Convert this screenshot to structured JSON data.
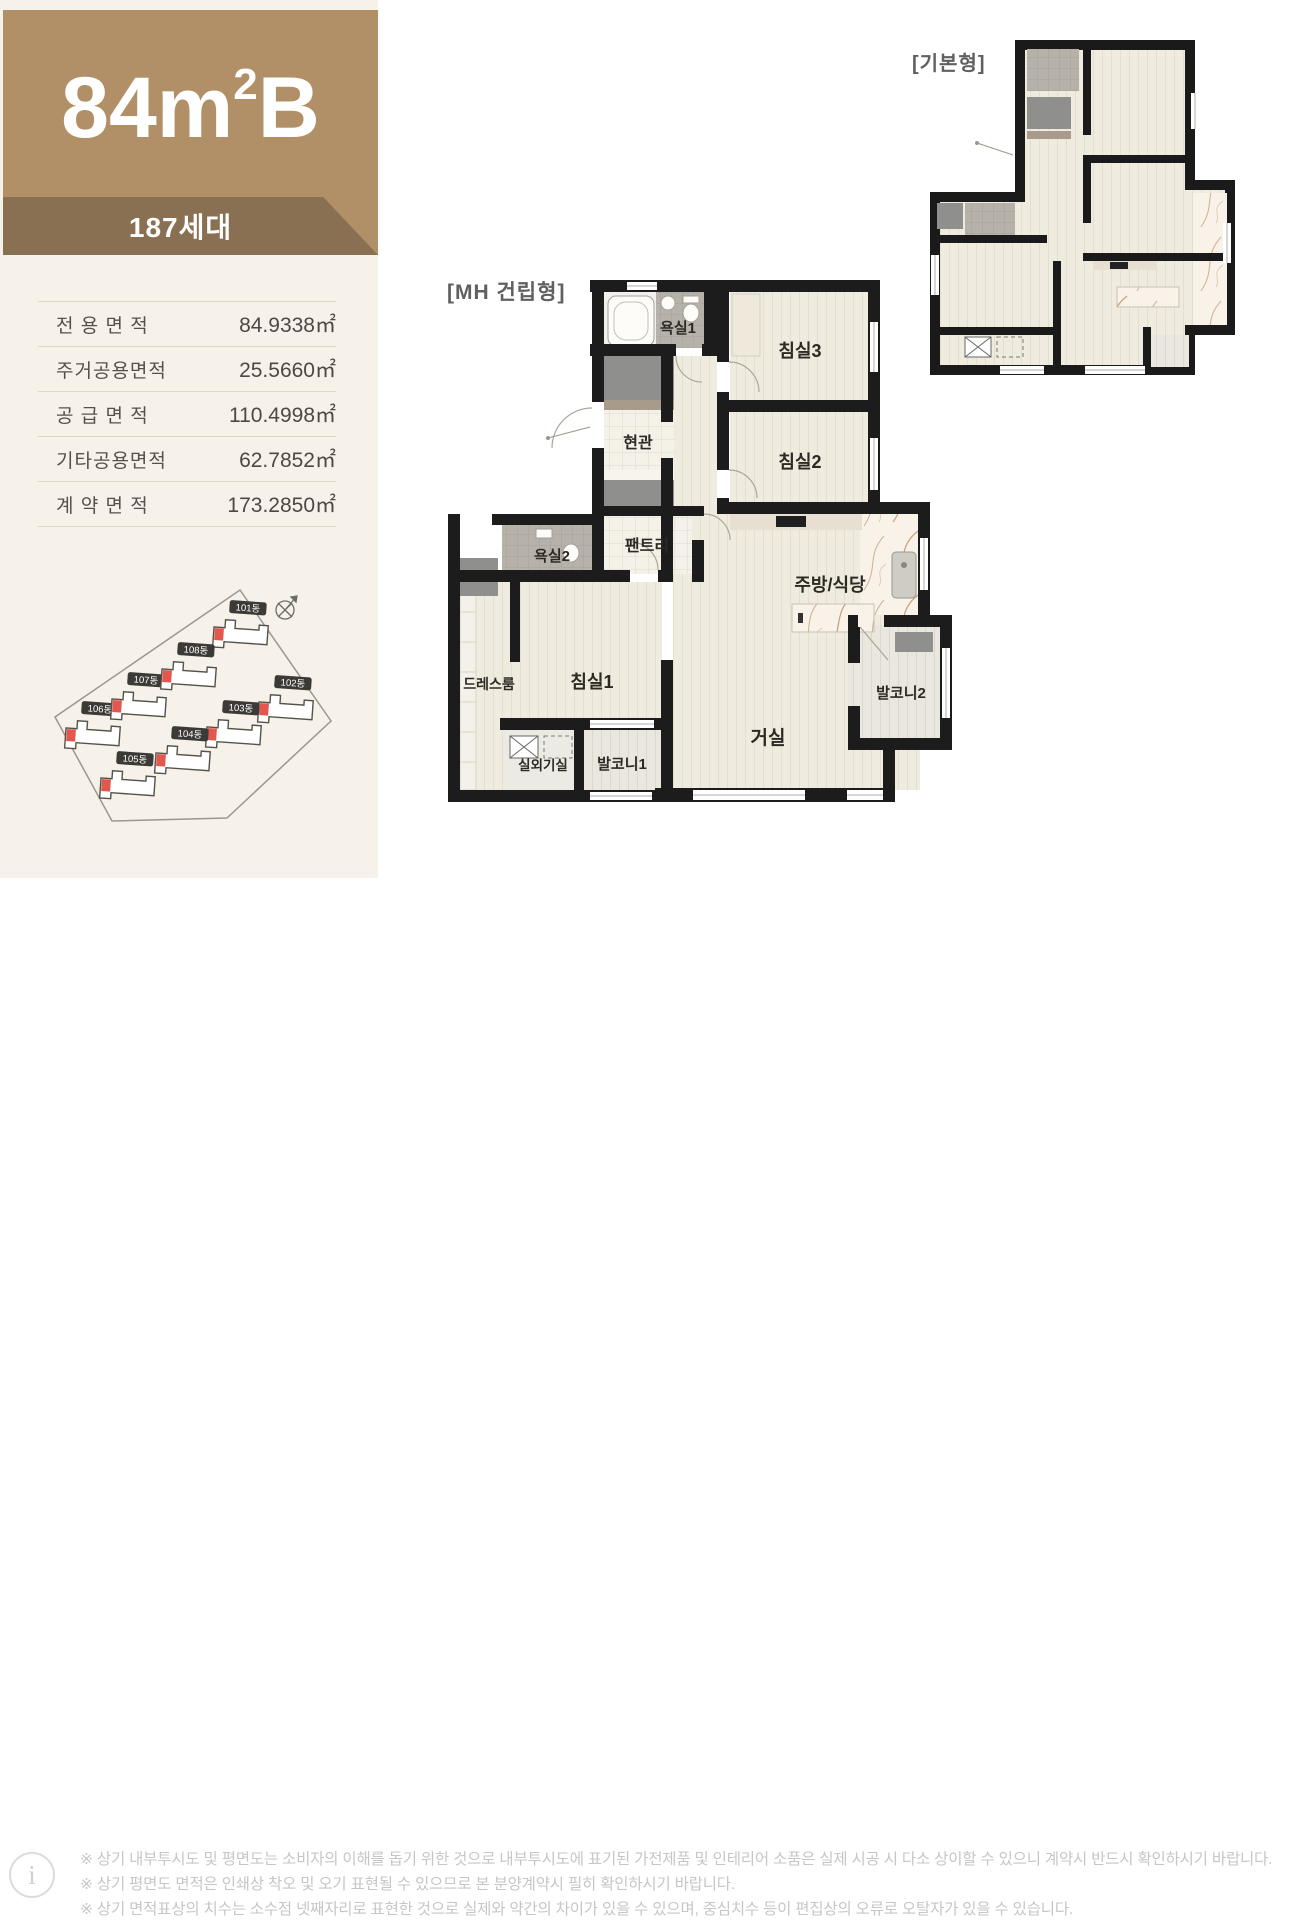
{
  "header": {
    "size_main": "84m",
    "size_sup": "2",
    "size_suffix": "B",
    "badge": "187세대"
  },
  "colors": {
    "brand_brown": "#b19068",
    "ribbon_brown": "#8a7053",
    "accent_red": "#e4574e"
  },
  "area_table": {
    "rows": [
      {
        "label": "전 용 면 적",
        "value": "84.9338㎡"
      },
      {
        "label": "주거공용면적",
        "value": "25.5660㎡"
      },
      {
        "label": "공 급 면 적",
        "value": "110.4998㎡"
      },
      {
        "label": "기타공용면적",
        "value": "62.7852㎡"
      },
      {
        "label": "계 약 면 적",
        "value": "173.2850㎡"
      }
    ]
  },
  "site_plan": {
    "buildings": [
      "101동",
      "102동",
      "103동",
      "104동",
      "105동",
      "106동",
      "107동",
      "108동"
    ]
  },
  "main_plan": {
    "title": "[MH 건립형]",
    "rooms": {
      "bath1": "욕실1",
      "bed3": "침실3",
      "entrance": "현관",
      "bed2": "침실2",
      "pantry": "팬트리",
      "bath2": "욕실2",
      "kitchen_dining": "주방/식당",
      "dress_room": "드레스룸",
      "bed1": "침실1",
      "living": "거실",
      "balcony2": "발코니2",
      "outdoor_unit": "실외기실",
      "balcony1": "발코니1"
    }
  },
  "sub_plan": {
    "title": "[기본형]"
  },
  "footer": {
    "notes": [
      "※ 상기 내부투시도 및 평면도는 소비자의 이해를 돕기 위한 것으로 내부투시도에 표기된 가전제품 및 인테리어 소품은 실제 시공 시 다소 상이할 수 있으니 계약시 반드시 확인하시기 바랍니다.",
      "※ 상기 평면도 면적은 인쇄상 착오 및 오기 표현될 수 있으므로 본 분양계약시 필히 확인하시기 바랍니다.",
      "※ 상기 면적표상의 치수는 소수점 넷째자리로 표현한 것으로 실제와 약간의 차이가 있을 수 있으며, 중심치수 등이 편집상의 오류로 오탈자가 있을 수 있습니다."
    ]
  }
}
